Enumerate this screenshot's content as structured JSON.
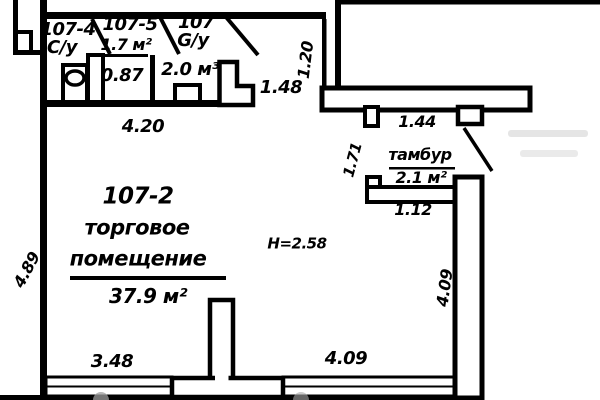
{
  "rooms": {
    "unit4": {
      "number": "107-4",
      "type": "С/у"
    },
    "unit5": {
      "number": "107-5",
      "area": "1.7 м²",
      "width": "0.87"
    },
    "unit": {
      "number": "107",
      "type": "G/у",
      "volume": "2.0 м³"
    },
    "main": {
      "number": "107-2",
      "name1": "торговое",
      "name2": "помещение",
      "area": "37.9 м²",
      "ceiling_height": "H=2.58"
    },
    "tambur": {
      "name": "тамбур",
      "area": "2.1 м²"
    }
  },
  "dims": {
    "w420": "4.20",
    "w148": "1.48",
    "v120": "1.20",
    "w144": "1.44",
    "v171": "1.71",
    "w112": "1.12",
    "v489": "4.89",
    "w348": "3.48",
    "w409": "4.09",
    "v409": "4.09"
  },
  "colors": {
    "line": "#000000",
    "bg": "#ffffff",
    "watermark": "#a8a8a8"
  }
}
